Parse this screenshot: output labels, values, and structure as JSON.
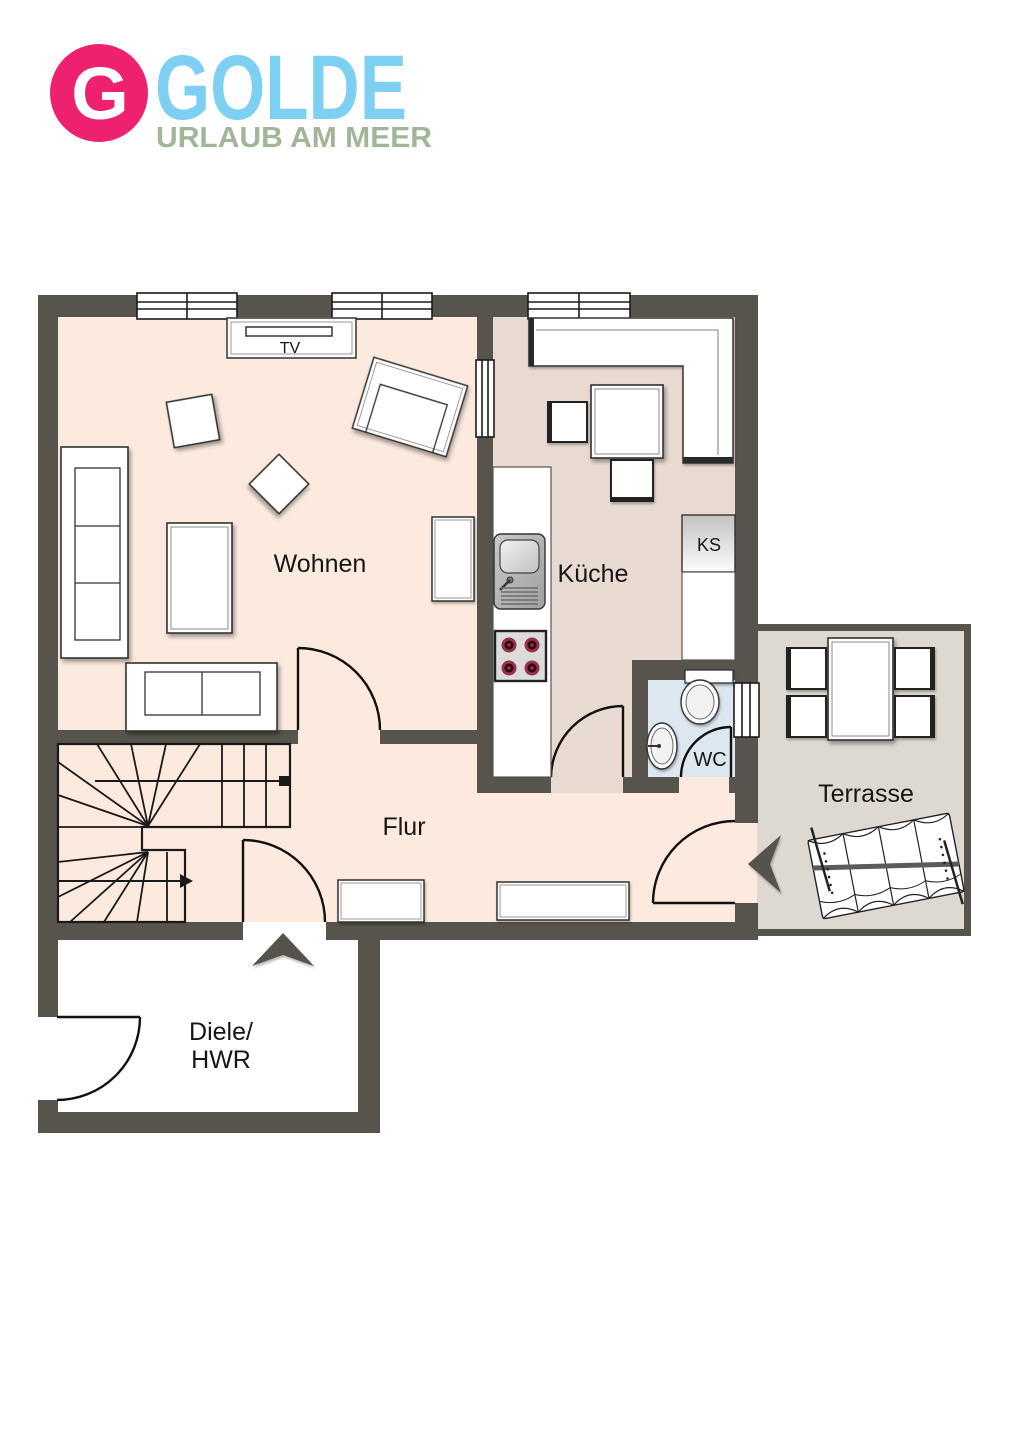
{
  "logo": {
    "badge_letter": "G",
    "brand": "GOLDE",
    "tagline": "URLAUB AM MEER"
  },
  "labels": {
    "living": "Wohnen",
    "kitchen": "Küche",
    "hall": "Flur",
    "terrace": "Terrasse",
    "wc": "WC",
    "utility_line1": "Diele/",
    "utility_line2": "HWR",
    "tv": "TV",
    "fridge": "KS"
  },
  "colors": {
    "logo_badge": "#ee2170",
    "logo_brand": "#7ed0f3",
    "logo_tagline": "#a3b598",
    "wall": "#57534d",
    "floor_living_hall": "#fceade",
    "floor_kitchen": "#e9dad1",
    "floor_wc": "#dce7f0",
    "floor_terrace": "#ded9d0",
    "floor_utility": "#ffffff",
    "stove_burner": "#98304a",
    "line": "#1a1a1a"
  }
}
